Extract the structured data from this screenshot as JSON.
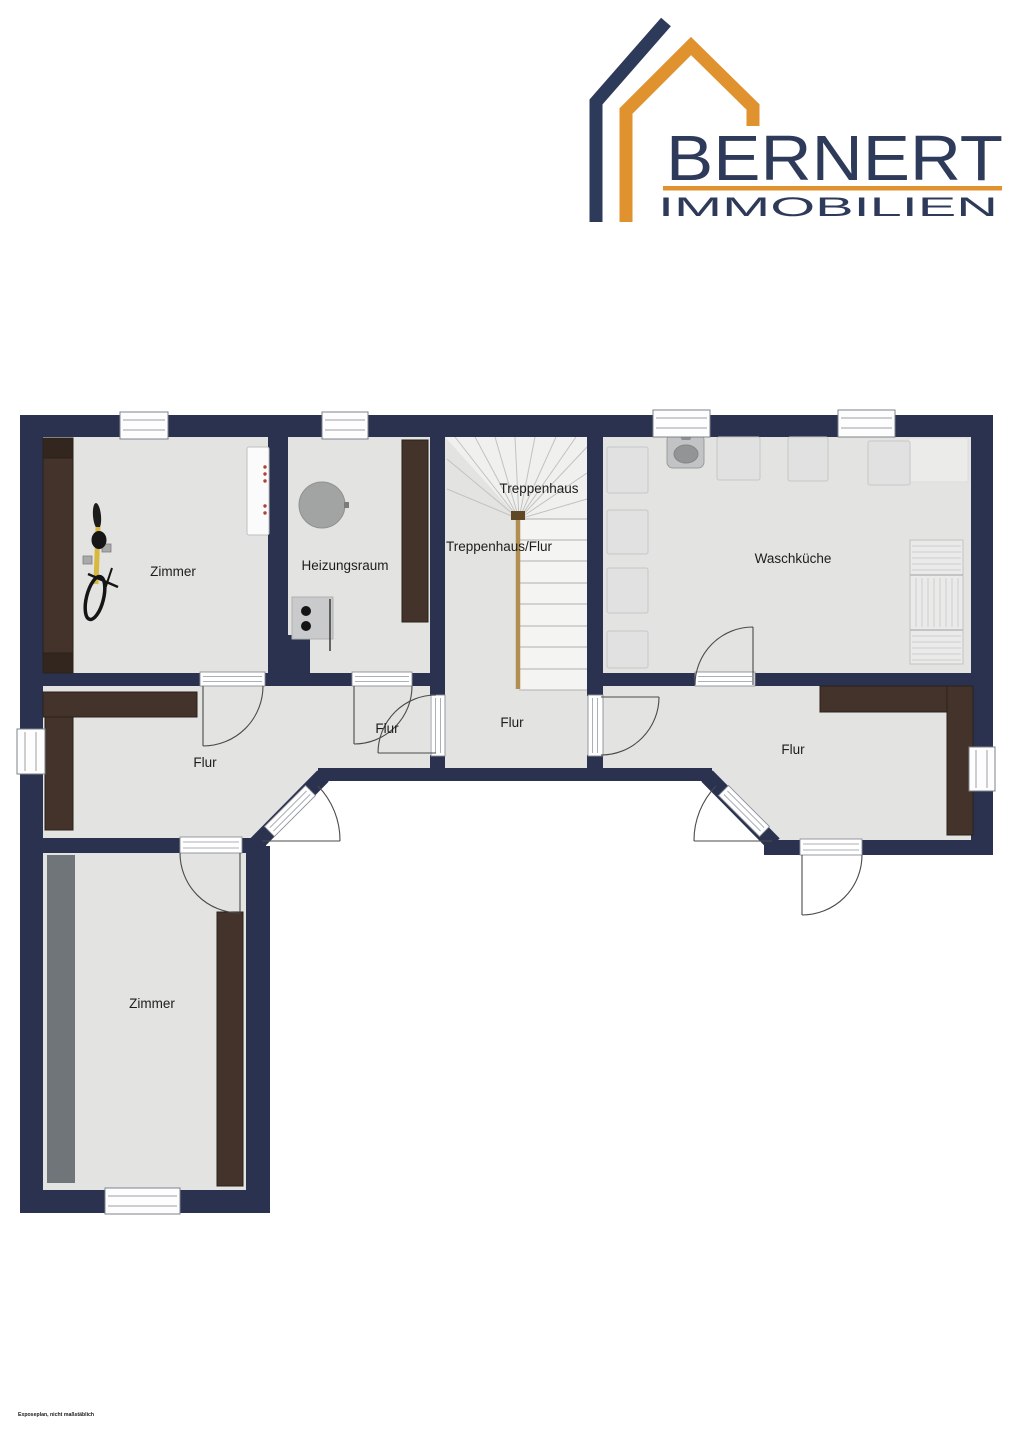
{
  "logo": {
    "brand": "BERNERT",
    "subtitle": "IMMOBILIEN",
    "navy": "#2e3a59",
    "orange": "#e0922f"
  },
  "floor_plan": {
    "wall_color": "#2a3250",
    "floor_color": "#e3e4e2",
    "furniture_color": "#43332a",
    "gray_panel_color": "#70757a",
    "railing_color": "#b28e52",
    "rooms": [
      {
        "id": "zimmer-top-left",
        "label": "Zimmer"
      },
      {
        "id": "heizungsraum",
        "label": "Heizungsraum"
      },
      {
        "id": "treppenhaus",
        "label": "Treppenhaus"
      },
      {
        "id": "treppenhaus-flur",
        "label": "Treppenhaus/Flur"
      },
      {
        "id": "waschkueche",
        "label": "Waschküche"
      },
      {
        "id": "flur-left",
        "label": "Flur"
      },
      {
        "id": "flur-small",
        "label": "Flur"
      },
      {
        "id": "flur-center",
        "label": "Flur"
      },
      {
        "id": "flur-right",
        "label": "Flur"
      },
      {
        "id": "zimmer-bottom-left",
        "label": "Zimmer"
      }
    ]
  },
  "footer": {
    "disclaimer": "Exposeplan, nicht maßstäblich"
  }
}
